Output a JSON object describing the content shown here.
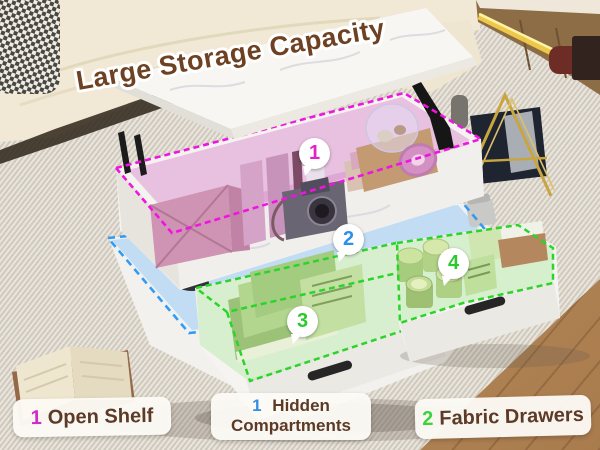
{
  "title": "Large Storage Capacity",
  "badges": [
    {
      "number": "1",
      "color": "#e321c6",
      "marks": "open shelf"
    },
    {
      "number": "2",
      "color": "#2b90ee",
      "marks": "hidden compartment"
    },
    {
      "number": "3",
      "color": "#2cc92c",
      "marks": "left fabric drawer"
    },
    {
      "number": "4",
      "color": "#2cc92c",
      "marks": "right fabric drawer"
    }
  ],
  "legend": {
    "items": [
      {
        "count": "1",
        "label": "Open Shelf",
        "count_color": "#cf2bc7"
      },
      {
        "count": "1",
        "label": "Hidden Compartments",
        "count_color": "#338fe3"
      },
      {
        "count": "2",
        "label": "Fabric Drawers",
        "count_color": "#3bd23b"
      }
    ]
  },
  "zones": [
    {
      "name": "open-shelf",
      "outline_color": "#ef14e0"
    },
    {
      "name": "hidden-compartment",
      "outline_color": "#349bf2"
    },
    {
      "name": "left-drawer",
      "outline_color": "#2bd42b"
    },
    {
      "name": "right-drawer",
      "outline_color": "#2bd42b"
    }
  ],
  "colors": {
    "title_text": "#6d4122",
    "title_outline": "#ffffff",
    "legend_text": "#5d3a26",
    "legend_bg": "#fcfaf5",
    "table_marble": "#f5f4f1",
    "rug": "#d8d3c7",
    "wood_floor": "#b5885c",
    "sofa": "#f1e9d5",
    "led_glow": "#ffd84a"
  }
}
